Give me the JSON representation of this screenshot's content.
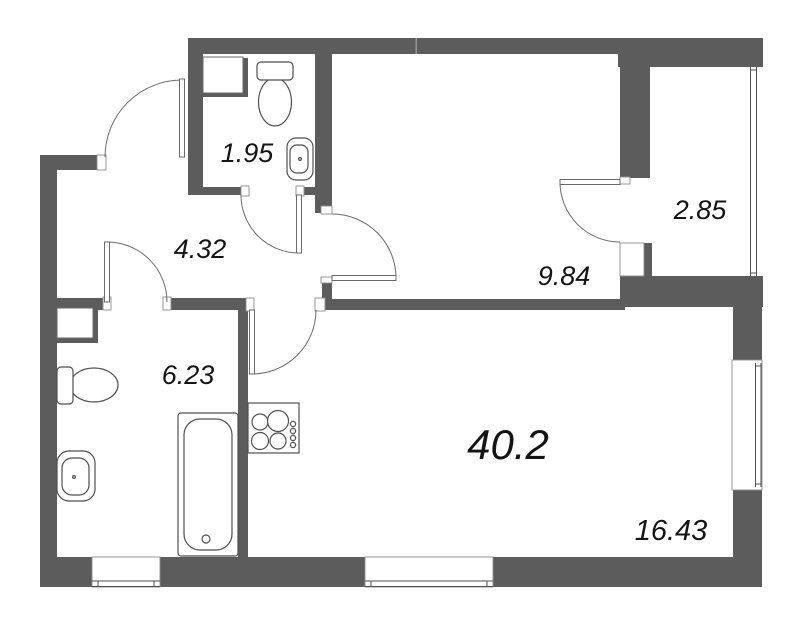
{
  "plan": {
    "title": "apartment floor plan",
    "total_area": "40.2",
    "rooms": [
      {
        "id": "bathroom-small",
        "area": "1.95"
      },
      {
        "id": "hallway",
        "area": "4.32"
      },
      {
        "id": "balcony",
        "area": "2.85"
      },
      {
        "id": "bedroom",
        "area": "9.84"
      },
      {
        "id": "bathroom-large",
        "area": "6.23"
      },
      {
        "id": "living-kitchen",
        "area": "16.43"
      }
    ],
    "colors": {
      "wall": "#5c5c5c",
      "line": "#4f4f4f",
      "text": "#141414",
      "background": "#ffffff"
    }
  }
}
